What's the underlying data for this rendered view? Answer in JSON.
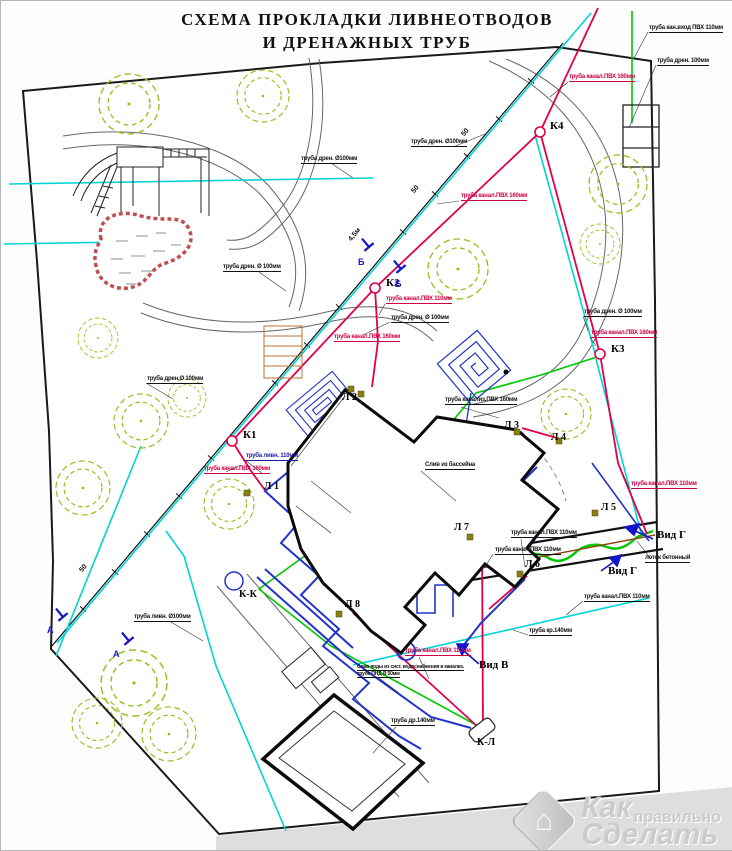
{
  "title": {
    "line1": "СХЕМА ПРОКЛАДКИ ЛИВНЕОТВОДОВ",
    "line2": "И ДРЕНАЖНЫХ ТРУБ"
  },
  "manholes": [
    {
      "id": "К1"
    },
    {
      "id": "К2"
    },
    {
      "id": "К3"
    },
    {
      "id": "К4"
    }
  ],
  "drains": [
    {
      "id": "Л 1"
    },
    {
      "id": "Л 2"
    },
    {
      "id": "Л 3"
    },
    {
      "id": "Л 4"
    },
    {
      "id": "Л 5"
    },
    {
      "id": "Л 6"
    },
    {
      "id": "Л 7"
    },
    {
      "id": "Л 8"
    }
  ],
  "connections": [
    {
      "id": "К-К"
    },
    {
      "id": "К-Л"
    }
  ],
  "views": [
    {
      "label": "Вид Г"
    },
    {
      "label": "Вид Г"
    },
    {
      "label": "Вид В"
    }
  ],
  "sections": [
    {
      "letter": "Б"
    },
    {
      "letter": "Б"
    },
    {
      "letter": "А"
    },
    {
      "letter": "А"
    }
  ],
  "dimensions": [
    {
      "text": "50"
    },
    {
      "text": "50"
    },
    {
      "text": "50"
    },
    {
      "text": "4,5м"
    }
  ],
  "pipe_labels": [
    {
      "text": "труба кан.вход ПВХ 110мм",
      "color": "black"
    },
    {
      "text": "труба дрен. 100мм",
      "color": "black"
    },
    {
      "text": "труба канал.ПВХ 160мм",
      "color": "red"
    },
    {
      "text": "труба дрен. Ø100мм",
      "color": "black"
    },
    {
      "text": "труба дрен. Ø100мм",
      "color": "black"
    },
    {
      "text": "труба канал.ПВХ 160мм",
      "color": "red"
    },
    {
      "text": "труба дрен. Ø 100мм",
      "color": "black"
    },
    {
      "text": "труба канал.ПВХ 110мм",
      "color": "red"
    },
    {
      "text": "труба дрен. Ø 100мм",
      "color": "black"
    },
    {
      "text": "труба канал.ПВХ 160мм",
      "color": "red"
    },
    {
      "text": "труба дрен. Ø 100мм",
      "color": "black"
    },
    {
      "text": "труба канал.ПВХ 160мм",
      "color": "red"
    },
    {
      "text": "труба дрен.Ø 100мм",
      "color": "black"
    },
    {
      "text": "труба канализ.ПВХ 160мм",
      "color": "black"
    },
    {
      "text": "труба ливн. 110мм",
      "color": "blue"
    },
    {
      "text": "труба канал.ПВХ 160мм",
      "color": "red"
    },
    {
      "text": "труба канал.ПВХ 110мм",
      "color": "red"
    },
    {
      "text": "труба канал.ПВХ 110мм",
      "color": "black"
    },
    {
      "text": "труба канал.ПВХ 110мм",
      "color": "black"
    },
    {
      "text": "труба канал.ПВХ 110мм",
      "color": "black"
    },
    {
      "text": "труба канал.ПВХ 110мм",
      "color": "red"
    },
    {
      "text": "Слив воды из сист. водоснабжения в канализ.",
      "color": "black"
    },
    {
      "text": "труба ПНД Ø 50мм",
      "color": "black"
    },
    {
      "text": "труба ливн. Ø100мм",
      "color": "black"
    },
    {
      "text": "труба др.140мм",
      "color": "black"
    },
    {
      "text": "лоток бетонный",
      "color": "black"
    },
    {
      "text": "Слив из бассейна",
      "color": "black"
    },
    {
      "text": "труба кр.140мм",
      "color": "black"
    }
  ],
  "watermark": {
    "part1": "Как",
    "part2": "правильно",
    "part3": "Сделать"
  },
  "colors": {
    "sewer_line": "#e0004c",
    "drain_line": "#00d4d4",
    "storm_line": "#2233cc",
    "feeder_line": "#00c800",
    "tree": "#94c11f",
    "label_red": "#cc0044"
  }
}
